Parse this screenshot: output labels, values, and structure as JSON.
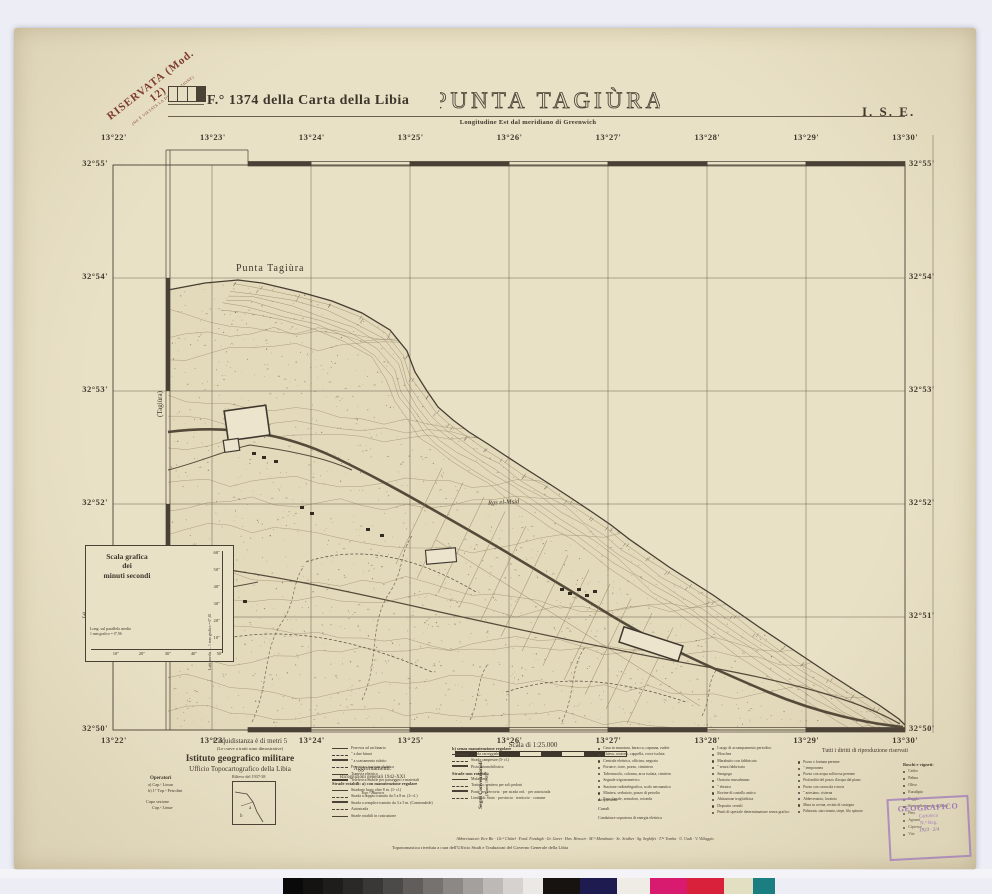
{
  "colors": {
    "photo_bg": "#edeef5",
    "paper": "#e9e1c6",
    "ink": "#3e362b",
    "classification_stamp": "#7d3a2c",
    "library_stamp": "#9d77ba",
    "band_dark": "#4a4136"
  },
  "header": {
    "classification_line1": "RISERVATA (Mod. 12)",
    "classification_line2": "(NE È VIETATA LA DIVULGAZIONE)",
    "sheet_ref": "F.° 1374 della Carta della Libia",
    "title": "PUNTA TAGIÙRA",
    "quadrant": "I. S. E.",
    "longitude_note": "Longitudine Est dal meridiano di Greenwich"
  },
  "graticule": {
    "top_longitudes": [
      "13°22'",
      "13°23'",
      "13°24'",
      "13°25'",
      "13°26'",
      "13°27'",
      "13°28'",
      "13°29'",
      "13°30'"
    ],
    "bottom_longitudes": [
      "13°22'",
      "13°23'",
      "13°24'",
      "13°25'",
      "13°26'",
      "13°27'",
      "13°28'",
      "13°29'",
      "13°30'"
    ],
    "left_latitudes": [
      "32°55'",
      "32°54'",
      "32°53'",
      "32°52'",
      "32°51'",
      "32°50'"
    ],
    "right_latitudes": [
      "32°55'",
      "32°54'",
      "32°53'",
      "32°52'",
      "32°51'",
      "32°50'"
    ]
  },
  "map_labels": {
    "punta": "Punta Tagiùra",
    "coast": "Ras el-Msid",
    "adjoining_sheet": "(Tagiùra)"
  },
  "scala_grafica": {
    "title1": "Scala grafica",
    "title2": "dei",
    "title3": "minuti secondi",
    "lat_axis_label": "Latit. media — 1 mm grafico = 0\",81",
    "lon_axis_label1": "Long. sul parallelo medio",
    "lon_axis_label2": "1 mm grafico = 0\",96",
    "vertical_ticks": [
      "60\"",
      "50\"",
      "40\"",
      "30\"",
      "20\"",
      "10\""
    ],
    "horizontal_ticks": [
      "10\"",
      "20\"",
      "30\"",
      "40\"",
      "50\""
    ]
  },
  "footer": {
    "equidistance": "L'equidistanza è di metri 5",
    "equidistance_note": "(Le curve a tratti sono dimostrative)",
    "scale_text": "Scala di 1:25.000",
    "institute1": "Istituto geografico militare",
    "institute2": "Ufficio Topocartografico della Libia",
    "operators_title": "Operatori",
    "operators": [
      "a) Cap.ᵉ Limar",
      "b) 1° Top.ᵒ Petrolini"
    ],
    "section_head1": "Capo sezione",
    "section_head2": "Cap.ᵉ Limar",
    "survey": "Rilievo del 1937-38",
    "updates_title": "Aggiornamenti:",
    "updates1": "Ricognizioni generali 1942-XXI",
    "updates2": "Top.ᵒ Bianca",
    "signs1": "Segni Convenzionali",
    "signs2": "(Norme 1938)",
    "rights": "Tutti i diritti di riproduzione riservati",
    "abbreviations": "Abbreviazioni: B.re Bir · Ch.ᵉᵗ Châtel · Fond. Fondugh · Gr. Garet · Hen. Henscìr · M.ᵗᵒ Marabutto · Sc. Sciàbet · Sg. Seghìfet · T.ᵇᵃ Tomba · U. Uadi · V. Villaggio",
    "revision": "Toponomastica riveduta a cura dell'Ufficio Studi e Traduzioni del Governo Generale della Libia"
  },
  "legend": {
    "rail": [
      "Ferrovia ad un binario",
      "″ a due binari",
      "″ a scartamento ridotto",
      "Ferrovia a trazione elettrica",
      "Tramvia elettrica",
      "Teleferica mobile per passeggeri e materiali"
    ],
    "roads_a_title": "Strade rotabili: a) con manutenzione regolare",
    "roads_a": [
      "Stradone largo oltre 8 m. (1ᵃ cl.)",
      "Strada a doppio transito da 5 a 8 m. (2ᵃ cl.)",
      "Strada a semplice transito da 3 a 5 m. (Camionabile)",
      "Autostrada",
      "Strade rotabili in costruzione"
    ],
    "roads_b_title": "b) senza manutenzione regolare",
    "roads_b": [
      "Strada carreggiabile (4ᵃ cl.)",
      "Strada campestre (5ᵃ cl.)",
      "Pista automobilistica"
    ],
    "mule_title": "Strade non rotabili:",
    "mule": [
      "Mulattiera",
      "Tratturo, sentiero per soli pedoni",
      "Ponti: per ferrovia · per strada ord. · per autostrada",
      "Limiti di: Stato · provincia · territorio · comune"
    ],
    "buildings": [
      "Casa in muratura, baracca, capanna, ruderi",
      "Chiesa, oratorio, cappella, croce isolata",
      "Centrale elettrica, officina, negozio",
      "Fornace, torre, pozzo, ciminiera",
      "Tabernacolo, colonna, arca isolata, cimitero",
      "Segnale trigonometrico",
      "Stazione radiotelegrafica, scalo aeronautico",
      "Miniera, serbatoio, pozzo di petrolio",
      "Faro, fanale, semaforo, rotonda"
    ],
    "aqueducts": "Acquedotti",
    "canals": "Canali",
    "power": "Condutture sopraterra di energia elettrica",
    "cult": [
      "Luogo di accampamento periodico",
      "Moschea",
      "Marabutto con fabbricato",
      "″ senza fabbricato",
      "Sinagoga",
      "Oratorio musulmano",
      "″ ebraico",
      "Rovine di castello antico",
      "Abitazione trogloditica",
      "Deposito cereali",
      "Punti di speciale determinazione senza grafico"
    ],
    "wells": [
      "Pozzo o fontana perenne",
      "″ temporanea",
      "Pozzo con acqua solforosa perenne",
      "Profondità del pozzo d'acqua dal piano",
      "Pozzo con carrucola e noria",
      "″ artesiano, cisterna",
      "Abbeveratoio, lavatoio",
      "Mura in rovina, recinti di sostegno",
      "Palizzata, staccionata, siepe, filo spinato"
    ],
    "woods_title": "Boschi e vigneti:",
    "woods": [
      "Cedro",
      "Palma",
      "Olivo",
      "Eucalipto",
      "Faggio",
      "Sterpaglia sparsa su duna",
      "Pino",
      "Agrumi",
      "Cipresso",
      "Vite"
    ]
  },
  "stamps": {
    "library": [
      "GEOGRAFICO",
      "Cartoteca",
      "N.° Reg.",
      "1923 · 2/4"
    ]
  },
  "calibration": {
    "gray_steps": [
      "#0a0a0a",
      "#141312",
      "#1f1d1c",
      "#2b2927",
      "#3a3836",
      "#4c4a48",
      "#605d5b",
      "#757270",
      "#8b8885",
      "#a3a09d",
      "#bcb9b6",
      "#d5d2cf",
      "#ebe9e6"
    ],
    "patches": [
      "#171310",
      "#1d1b4f",
      "#efece6",
      "#d81b6e",
      "#d9213c",
      "#e3dfc2",
      "#1b7e80"
    ]
  }
}
